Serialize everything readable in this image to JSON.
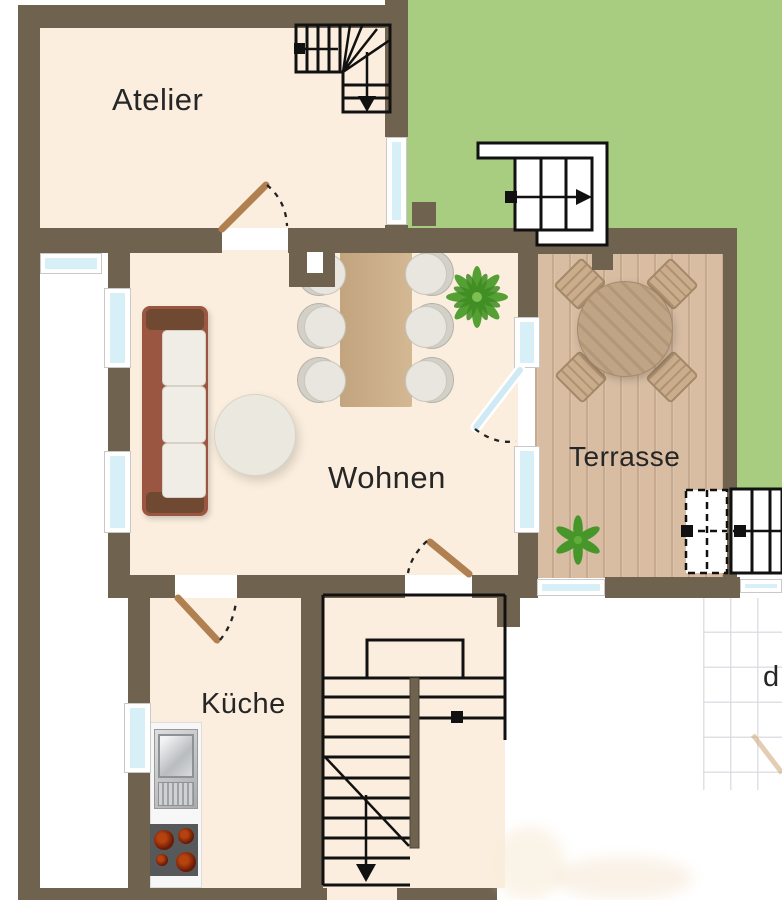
{
  "rooms": {
    "atelier": "Atelier",
    "wohnen": "Wohnen",
    "terrasse": "Terrasse",
    "kueche": "Küche"
  },
  "edge_text": {
    "partial_label": "d"
  },
  "colors": {
    "wall": "#6f6350",
    "floor": "#fbeede",
    "garden": "#a8cd80",
    "deck": "#d8bda3",
    "glass": "#d7f0f8",
    "door": "#b08050",
    "label": "#262626"
  }
}
